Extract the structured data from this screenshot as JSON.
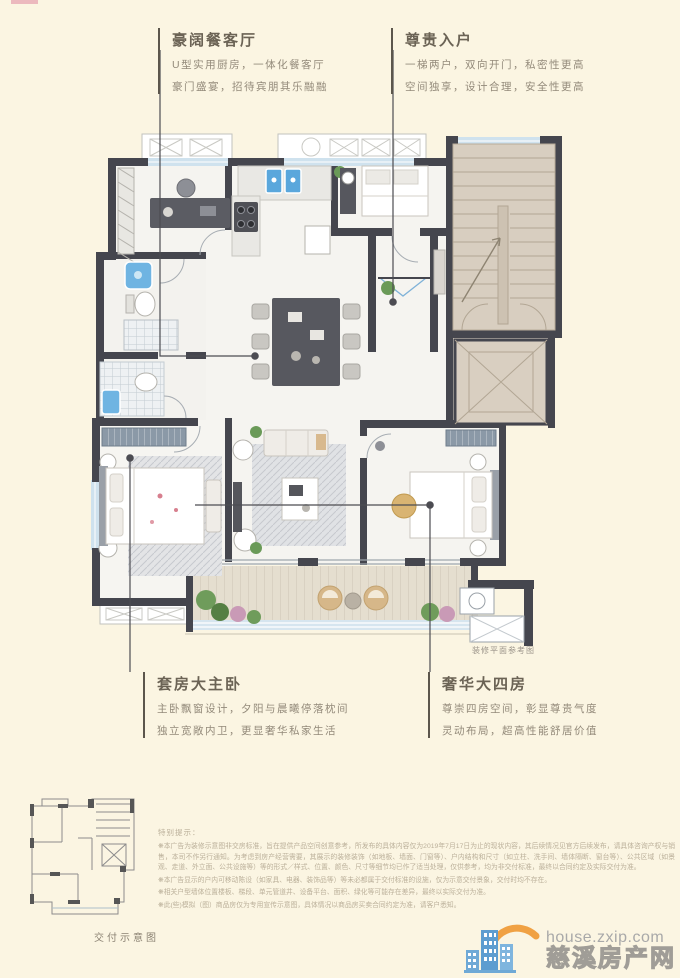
{
  "page": {
    "bg": "#fbf5e2"
  },
  "annotations": {
    "top_left": {
      "title": "豪阔餐客厅",
      "lines": [
        "U型实用厨房，一体化餐客厅",
        "豪门盛宴，招待宾朋其乐融融"
      ]
    },
    "top_right": {
      "title": "尊贵入户",
      "lines": [
        "一梯两户，双向开门，私密性更高",
        "空间独享，设计合理，安全性更高"
      ]
    },
    "bottom_left": {
      "title": "套房大主卧",
      "lines": [
        "主卧飘窗设计，夕阳与晨曦停落枕间",
        "独立宽敞内卫，更显奢华私家生活"
      ]
    },
    "bottom_right": {
      "title": "奢华大四房",
      "lines": [
        "尊崇四房空间，彰显尊贵气度",
        "灵动布局，超高性能舒居价值"
      ]
    }
  },
  "plan": {
    "caption": "装修平面参考图"
  },
  "thumbnail": {
    "caption": "交付示意图"
  },
  "disclaimer": {
    "heading": "特别提示：",
    "items": [
      "❋本广告为装修示意图非交房标准，旨在提供产品空间创意参考，所发布的具体内容仅为2019年7月17日为止的现状内容，其后续情况见官方后续发布，请具体咨询产权与销售，本司不作另行通知。为考虑到房产经营需要，其展示的装修装饰（如地板、墙面、门窗等）、户内结构和尺寸（如立柱、洗手间、墙体隔断、窗台等）、公共区域（如景观、走道、外立面、公共设施等）等的形式／样式、位置、颜色、尺寸等细节均已作了适当处理，仅供参考，均为非交付标准，最终以合同约定及实际交付为准。",
      "❋本广告显示的户内可移动陈设（如家具、电器、装饰品等）等未必都属于交付标准的设施，仅为示意交付景象，交付时均不存在。",
      "❋相关户型墙体位置楼板、梯段、单元管道井、设备平台、面积、绿化等可能存在差异，最终以实际交付为准。",
      "❋此(些)模拟（图）商品房仅为专用宣传示意图，具体情况以商品房买卖合同约定为准，请客户悉知。"
    ]
  },
  "watermark": {
    "domain": "house.zxip.com",
    "site_name": "慈溪房产网"
  },
  "colors": {
    "wall": "#45464e",
    "stair_floor": "#d8cec0",
    "window": "#cfe2ee",
    "fixture_blue": "#5aa7dc",
    "accent_orange": "#f0a143",
    "brand_blue": "#5d9dd0"
  }
}
